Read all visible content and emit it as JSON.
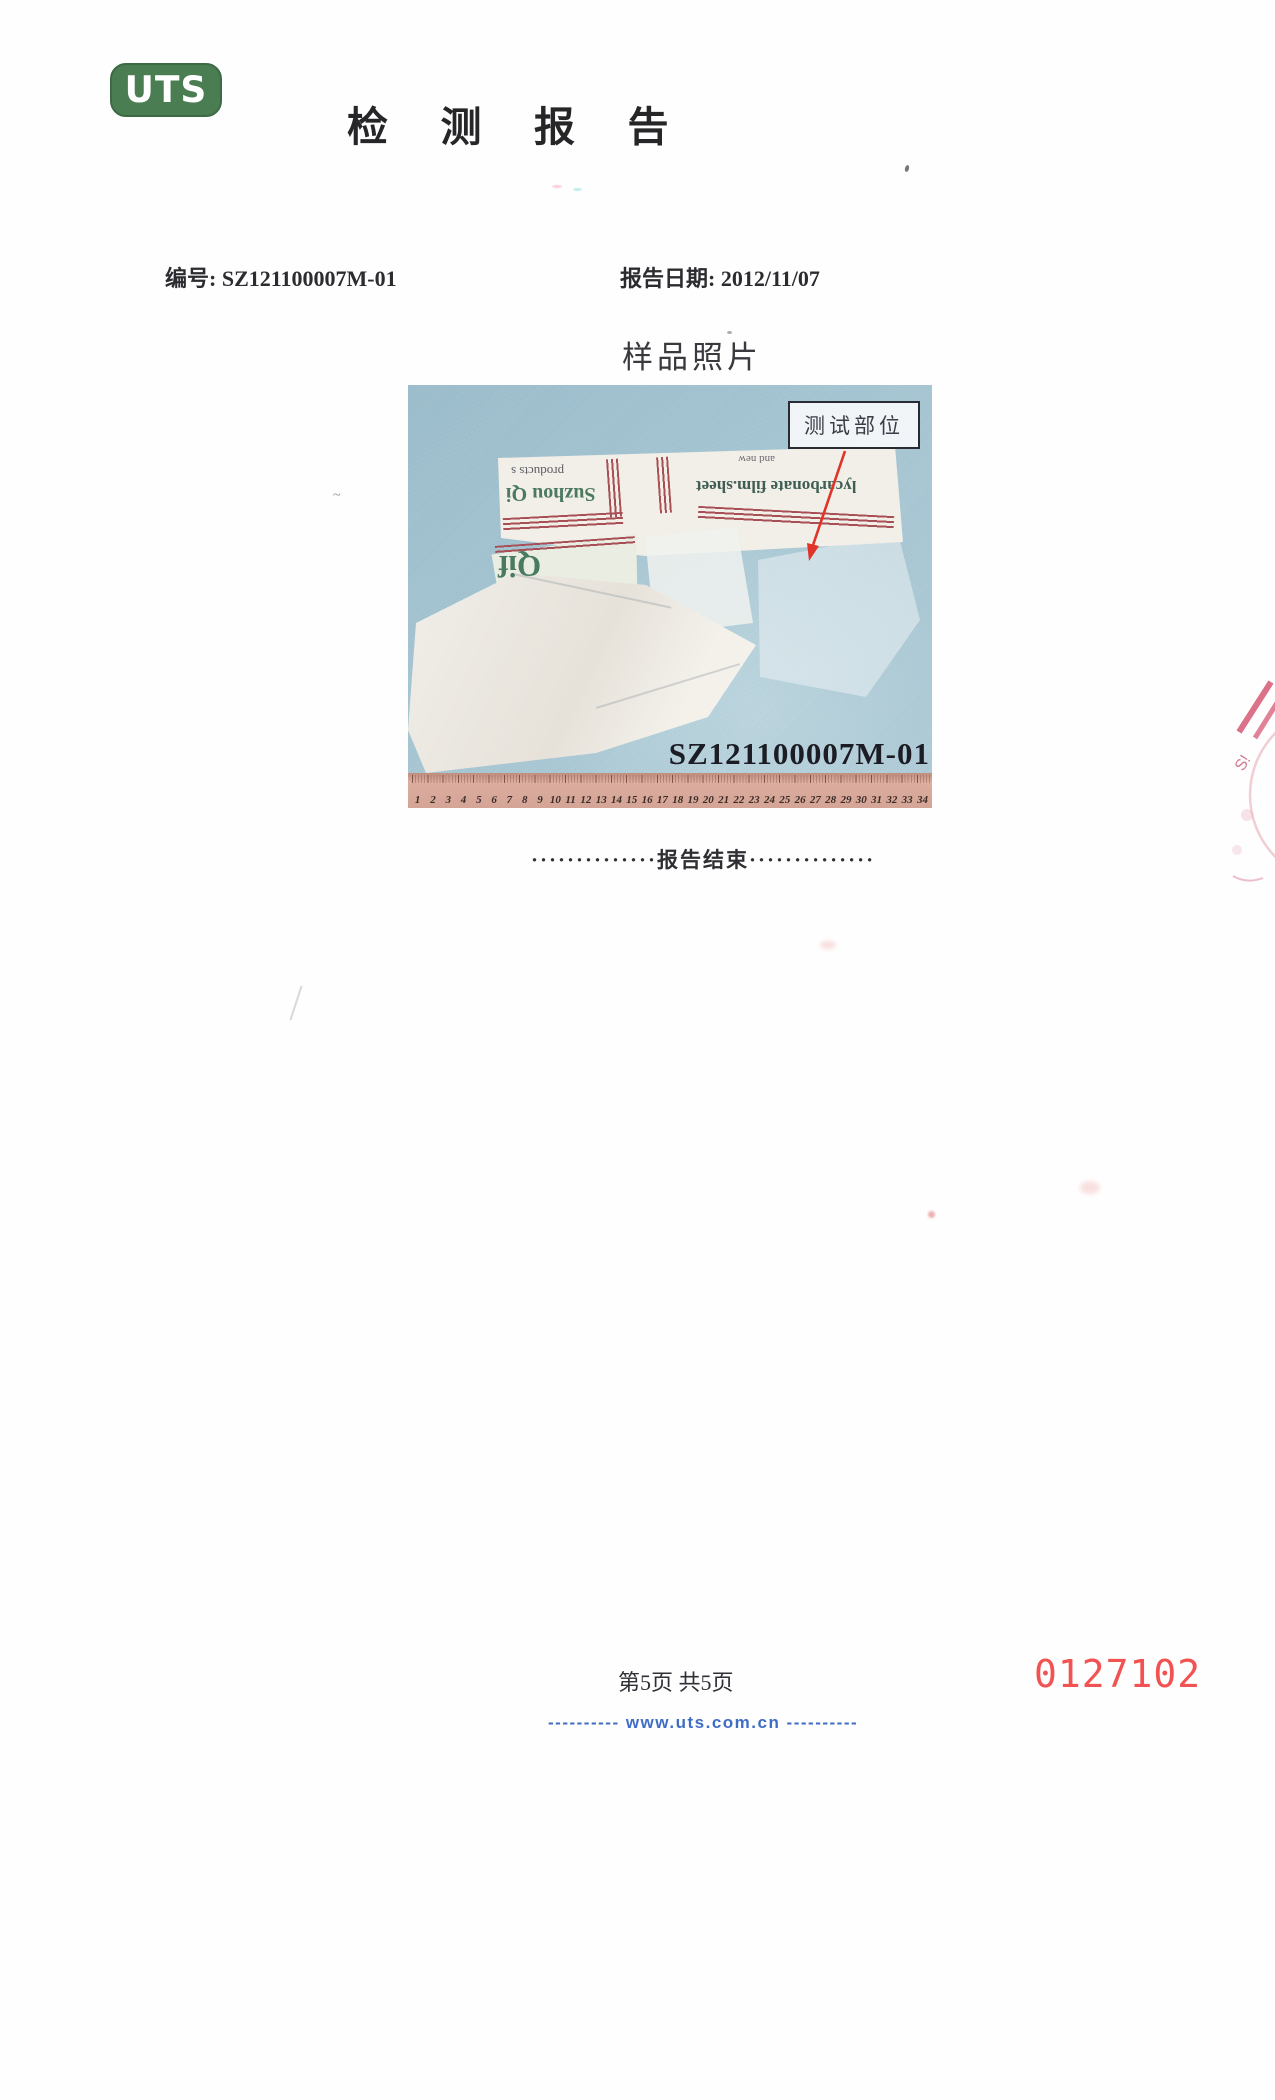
{
  "header": {
    "logo_text": "UTS",
    "title": "检测报告"
  },
  "meta": {
    "report_no_label": "编号:",
    "report_no": "SZ121100007M-01",
    "report_date_label": "报告日期:",
    "report_date": "2012/11/07"
  },
  "section": {
    "title": "样品照片"
  },
  "photo": {
    "callout_label": "测试部位",
    "sample_id": "SZ121100007M-01",
    "ruler_numbers": [
      1,
      2,
      3,
      4,
      5,
      6,
      7,
      8,
      9,
      10,
      11,
      12,
      13,
      14,
      15,
      16,
      17,
      18,
      19,
      20,
      21,
      22,
      23,
      24,
      25,
      26,
      27,
      28,
      29,
      30,
      31,
      32,
      33,
      34
    ],
    "bag_texts": {
      "line_products": "products s",
      "line_suzhou": "Suzhou Qi",
      "line_and_new": "and new",
      "line_film": "lycarbonate film.sheet",
      "line_qif": "Qif"
    }
  },
  "end_marker": {
    "text": "··············报告结束··············"
  },
  "footer": {
    "page_indicator": "第5页 共5页",
    "website": "---------- www.uts.com.cn ----------",
    "stamp_number": "0127102"
  },
  "colors": {
    "logo_green": "#4b7d52",
    "ink": "#2b2b30",
    "url_blue": "#3f6cc5",
    "stamp_red": "#f25352",
    "arrow_red": "#e03428",
    "photo_blue": "#a7c7d4",
    "ruler_tan": "#d4a496",
    "stripe_red": "#a84f55",
    "bag_green": "#4a7a60"
  }
}
